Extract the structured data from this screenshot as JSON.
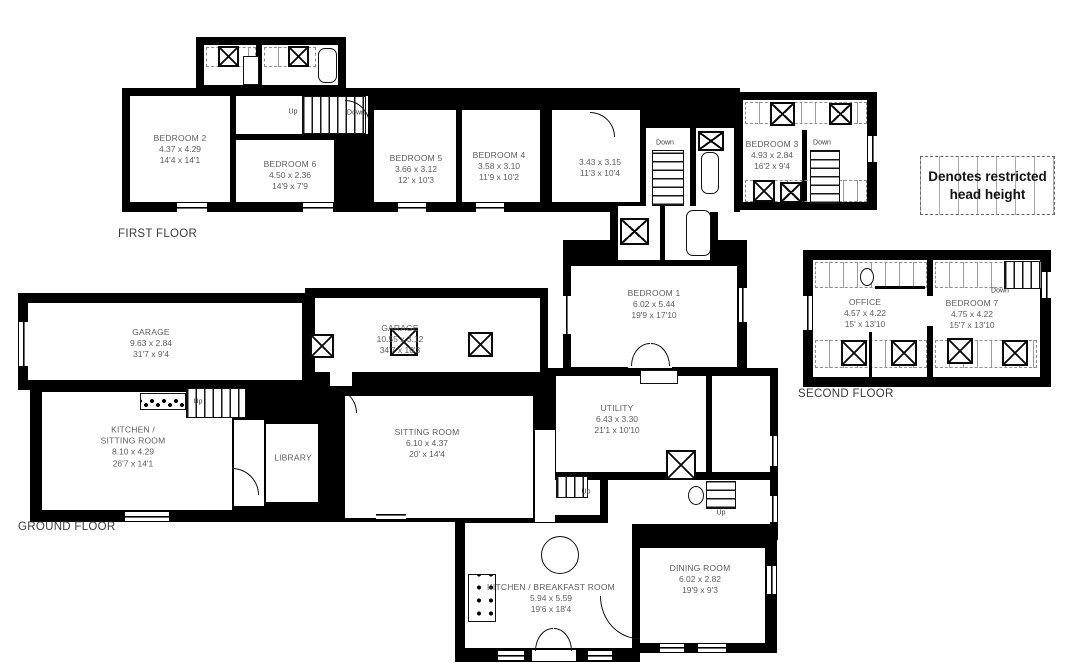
{
  "legend": {
    "line1": "Denotes restricted",
    "line2": "head height"
  },
  "labels": {
    "up": "Up",
    "down": "Down"
  },
  "floors": {
    "first": {
      "label": "FIRST FLOOR",
      "rooms": {
        "bedroom2": {
          "name": "BEDROOM 2",
          "metric": "4.37 x 4.29",
          "imperial": "14'4 x 14'1"
        },
        "bedroom6": {
          "name": "BEDROOM 6",
          "metric": "4.50 x 2.36",
          "imperial": "14'9 x 7'9"
        },
        "bedroom5": {
          "name": "BEDROOM 5",
          "metric": "3.66 x 3.12",
          "imperial": "12' x 10'3"
        },
        "bedroom4": {
          "name": "BEDROOM 4",
          "metric": "3.58 x 3.10",
          "imperial": "11'9 x 10'2"
        },
        "unnamed": {
          "metric": "3.43 x 3.15",
          "imperial": "11'3 x 10'4"
        },
        "bedroom3": {
          "name": "BEDROOM 3",
          "metric": "4.93 x 2.84",
          "imperial": "16'2 x 9'4"
        },
        "bedroom1": {
          "name": "BEDROOM 1",
          "metric": "6.02 x 5.44",
          "imperial": "19'9 x 17'10"
        }
      }
    },
    "second": {
      "label": "SECOND FLOOR",
      "rooms": {
        "office": {
          "name": "OFFICE",
          "metric": "4.57 x 4.22",
          "imperial": "15' x 13'10"
        },
        "bedroom7": {
          "name": "BEDROOM 7",
          "metric": "4.75 x 4.22",
          "imperial": "15'7 x 13'10"
        }
      }
    },
    "ground": {
      "label": "GROUND FLOOR",
      "rooms": {
        "garage1": {
          "name": "GARAGE",
          "metric": "9.63 x 2.84",
          "imperial": "31'7 x 9'4"
        },
        "garage2": {
          "name": "GARAGE",
          "metric": "10.55 x 3.12",
          "imperial": "34'7 x 10'3"
        },
        "kitchen_sitting": {
          "name": "KITCHEN /",
          "name2": "SITTING ROOM",
          "metric": "8.10 x 4.29",
          "imperial": "26'7 x 14'1"
        },
        "library": {
          "name": "LIBRARY"
        },
        "sitting": {
          "name": "SITTING ROOM",
          "metric": "6.10 x 4.37",
          "imperial": "20' x 14'4"
        },
        "utility": {
          "name": "UTILITY",
          "metric": "6.43 x 3.30",
          "imperial": "21'1 x 10'10"
        },
        "kitchen_breakfast": {
          "name": "KITCHEN / BREAKFAST ROOM",
          "metric": "5.94 x 5.59",
          "imperial": "19'6 x 18'4"
        },
        "dining": {
          "name": "DINING ROOM",
          "metric": "6.02 x 2.82",
          "imperial": "19'9 x 9'3"
        }
      }
    }
  }
}
